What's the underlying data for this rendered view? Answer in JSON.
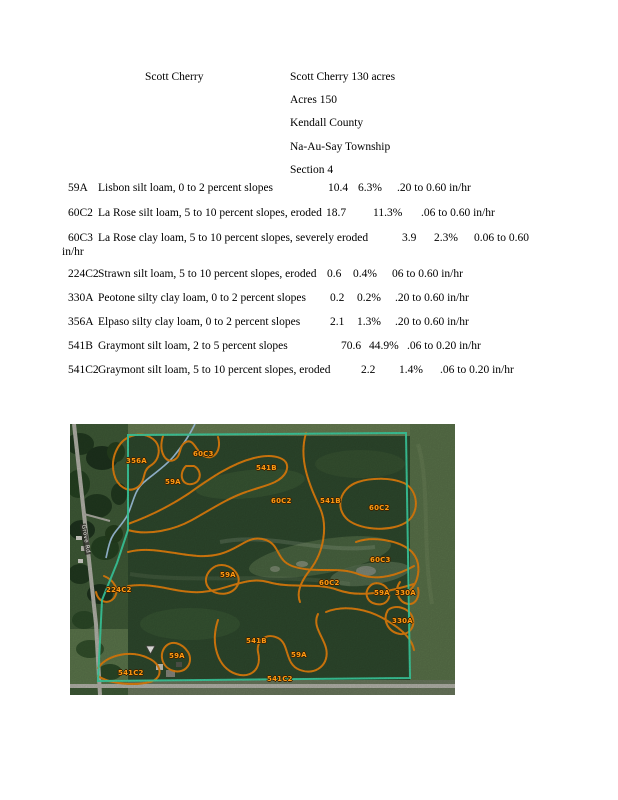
{
  "header": {
    "owner_name": "Scott Cherry",
    "info_lines": [
      "Scott Cherry 130 acres",
      "Acres 150",
      "Kendall County",
      "Na-Au-Say Township",
      "Section 4"
    ]
  },
  "soil_table": {
    "rows": [
      {
        "code": "59A",
        "description": "Lisbon silt loam, 0 to 2 percent slopes",
        "acres": "10.4",
        "percent": "6.3%",
        "rate": ".20 to 0.60 in/hr"
      },
      {
        "code": "60C2",
        "description": "La Rose silt loam, 5 to 10 percent slopes, eroded",
        "acres": "18.7",
        "percent": "11.3%",
        "rate": ".06 to 0.60 in/hr"
      },
      {
        "code": "60C3",
        "description": "La Rose clay loam, 5 to 10 percent slopes, severely eroded",
        "acres": "3.9",
        "percent": "2.3%",
        "rate": "0.06 to 0.60",
        "rate_wrap": "in/hr"
      },
      {
        "code": "224C2",
        "description": "Strawn silt loam, 5 to 10 percent slopes, eroded",
        "acres": "0.6",
        "percent": "0.4%",
        "rate": "06 to 0.60 in/hr"
      },
      {
        "code": "330A",
        "description": "Peotone silty clay loam, 0 to 2 percent slopes",
        "acres": "0.2",
        "percent": "0.2%",
        "rate": ".20 to 0.60 in/hr"
      },
      {
        "code": "356A",
        "description": "Elpaso silty clay loam, 0 to 2 percent slopes",
        "acres": "2.1",
        "percent": "1.3%",
        "rate": ".20 to 0.60 in/hr"
      },
      {
        "code": "541B",
        "description": "Graymont silt loam, 2 to 5 percent slopes",
        "acres": "70.6",
        "percent": "44.9%",
        "rate": ".06 to 0.20 in/hr"
      },
      {
        "code": "541C2",
        "description": "Graymont silt loam, 5 to 10 percent slopes, eroded",
        "acres": "2.2",
        "percent": "1.4%",
        "rate": ".06 to 0.20 in/hr"
      }
    ]
  },
  "map": {
    "road_label": "Grove Rd",
    "labels": [
      "356A",
      "60C3",
      "541B",
      "59A",
      "60C2",
      "541B",
      "60C2",
      "60C3",
      "59A",
      "60C2",
      "59A",
      "330A",
      "330A",
      "224C2",
      "541B",
      "59A",
      "59A",
      "541C2",
      "541C2"
    ],
    "colors": {
      "property_boundary": "#3ed8a8",
      "soil_lines": "#e6830e",
      "label_text": "#ff9a12",
      "stream": "#a9cdec",
      "field": "#2f4a2e"
    }
  }
}
